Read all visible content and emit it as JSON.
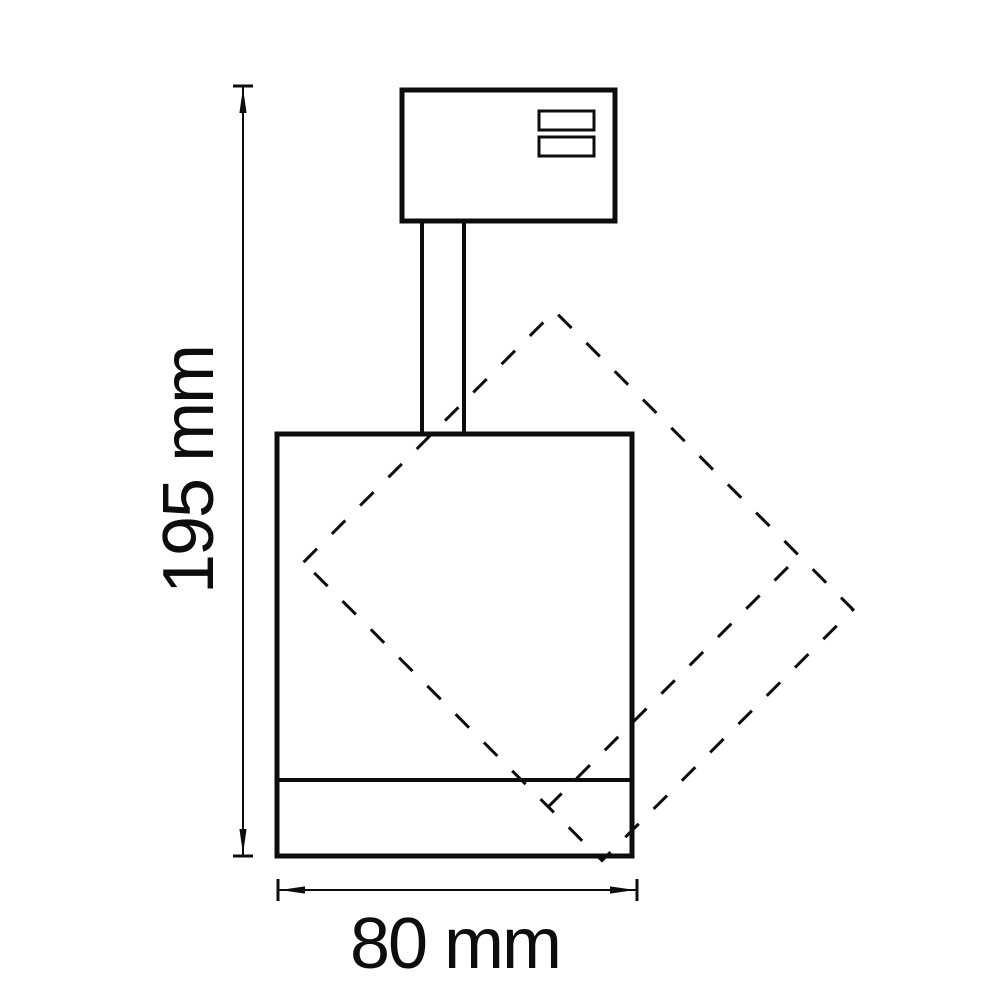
{
  "drawing": {
    "background_color": "#ffffff",
    "line_color": "#0d0d0d",
    "labels": {
      "height_dimension": "195 mm",
      "width_dimension": "80 mm"
    },
    "values": {
      "height": 195,
      "width": 80,
      "unit": "mm"
    }
  }
}
